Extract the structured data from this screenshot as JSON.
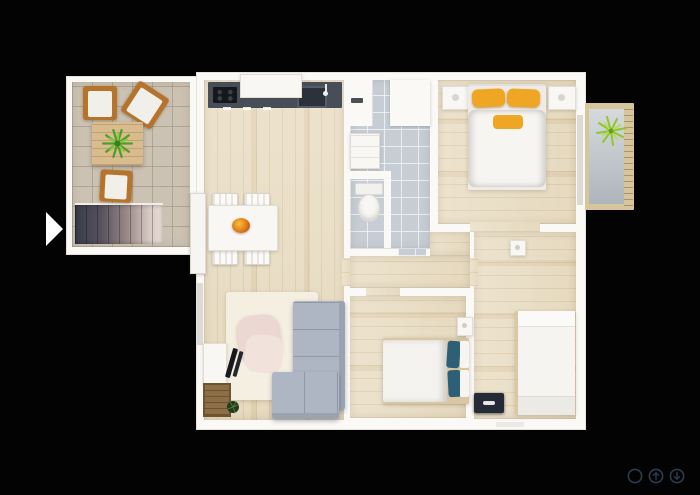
{
  "viewer": {
    "background_color": "#030303",
    "nav_next": {
      "icon": "play-triangle-icon",
      "color": "#ffffff",
      "title": "Next image"
    },
    "controls": {
      "icon_color": "#2b3d4e",
      "items": [
        {
          "icon": "circle-icon",
          "title": "Circle"
        },
        {
          "icon": "arrow-up-circle-icon",
          "title": "Arrow up"
        },
        {
          "icon": "arrow-down-circle-icon",
          "title": "Arrow down"
        }
      ]
    }
  },
  "floorplan": {
    "kind": "3D apartment floor plan render, top-down",
    "palette": {
      "wall": "#faf9f6",
      "wood_floor": "#eadfc6",
      "terrace_tile": "#cbc2b3",
      "bathroom_tile": "#c6cdd5",
      "kitchen_counter": "#474e57",
      "sofa_grey": "#aeb6c3",
      "pillow_yellow": "#f0a625",
      "pillow_teal": "#2d6076",
      "chair_wood": "#b5732b",
      "railing_wood": "#d7c59c",
      "plant_green": "#6ab52f",
      "rug_cream": "#f5efe2",
      "armchair_blush": "#ecd8d2",
      "stairs_dark": "#3c3f4c",
      "chest_dark": "#242b36"
    },
    "rooms": [
      {
        "name": "terrace",
        "items": [
          "wood-chair",
          "wood-chair",
          "wood-chair",
          "coffee-table",
          "plant",
          "stairs",
          "glass-door"
        ]
      },
      {
        "name": "kitchen-dining-living",
        "items": [
          "kitchen-counter",
          "cooktop",
          "sink",
          "window-sill",
          "dining-table",
          "dining-chairs-4",
          "fruit-bowl",
          "rug",
          "armchair",
          "corner-sofa",
          "tv-console",
          "tv",
          "doormat",
          "potted-plant"
        ]
      },
      {
        "name": "bathroom",
        "items": [
          "shower",
          "faucet",
          "vanity",
          "toilet"
        ]
      },
      {
        "name": "bedroom-1",
        "items": [
          "double-bed",
          "yellow-pillow",
          "yellow-pillow",
          "yellow-throw",
          "nightstand",
          "nightstand",
          "balcony-door"
        ]
      },
      {
        "name": "balcony",
        "items": [
          "plant",
          "wood-railing"
        ]
      },
      {
        "name": "hallway",
        "items": []
      },
      {
        "name": "bedroom-2",
        "items": [
          "double-bed",
          "teal-pillow",
          "teal-pillow",
          "nightstand"
        ]
      },
      {
        "name": "bedroom-3",
        "items": [
          "single-bed",
          "dark-chest",
          "wall-cabinet"
        ]
      }
    ]
  }
}
